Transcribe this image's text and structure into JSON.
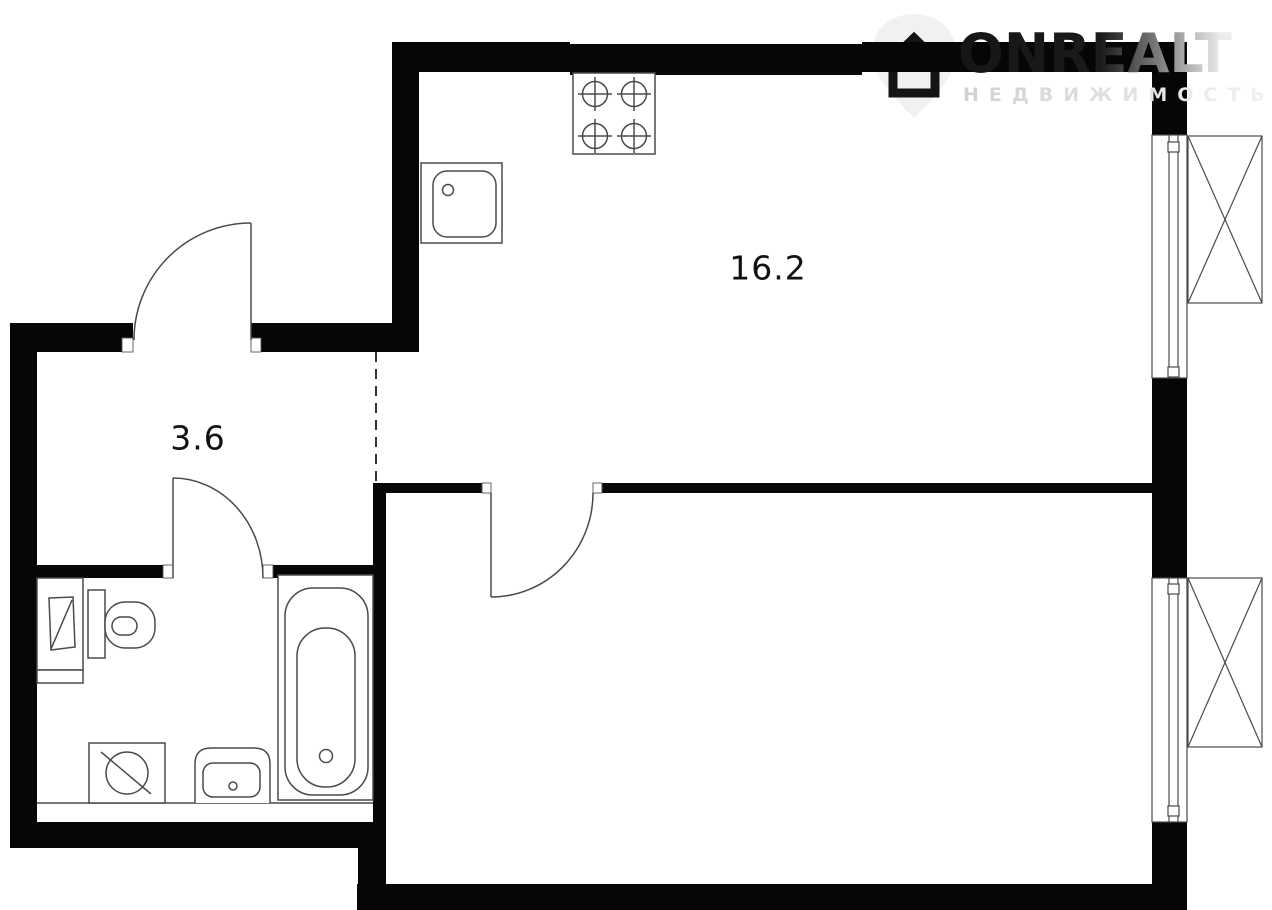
{
  "page": {
    "background_color": "#ffffff",
    "wall_color": "#060606",
    "line_color": "#4a4a4a"
  },
  "watermark": {
    "brand": "ONREALT",
    "subtitle": "НЕДВИЖИМОСТЬ",
    "icon": "house-pin-icon",
    "brand_gradient_start": "#161616",
    "brand_gradient_end": "#ececec",
    "subtitle_color": "#dcdcdc"
  },
  "rooms": [
    {
      "id": "kitchen-living-room",
      "area_label": "16.2"
    },
    {
      "id": "hallway",
      "area_label": "3.6"
    }
  ],
  "fixtures": [
    "stove-icon",
    "kitchen-sink-icon",
    "bathtub-icon",
    "toilet-icon",
    "washing-machine-icon",
    "wash-basin-icon",
    "bathroom-cabinet-icon",
    "window-icon",
    "window-icon",
    "entrance-door-icon",
    "bathroom-door-icon",
    "bedroom-door-icon"
  ]
}
